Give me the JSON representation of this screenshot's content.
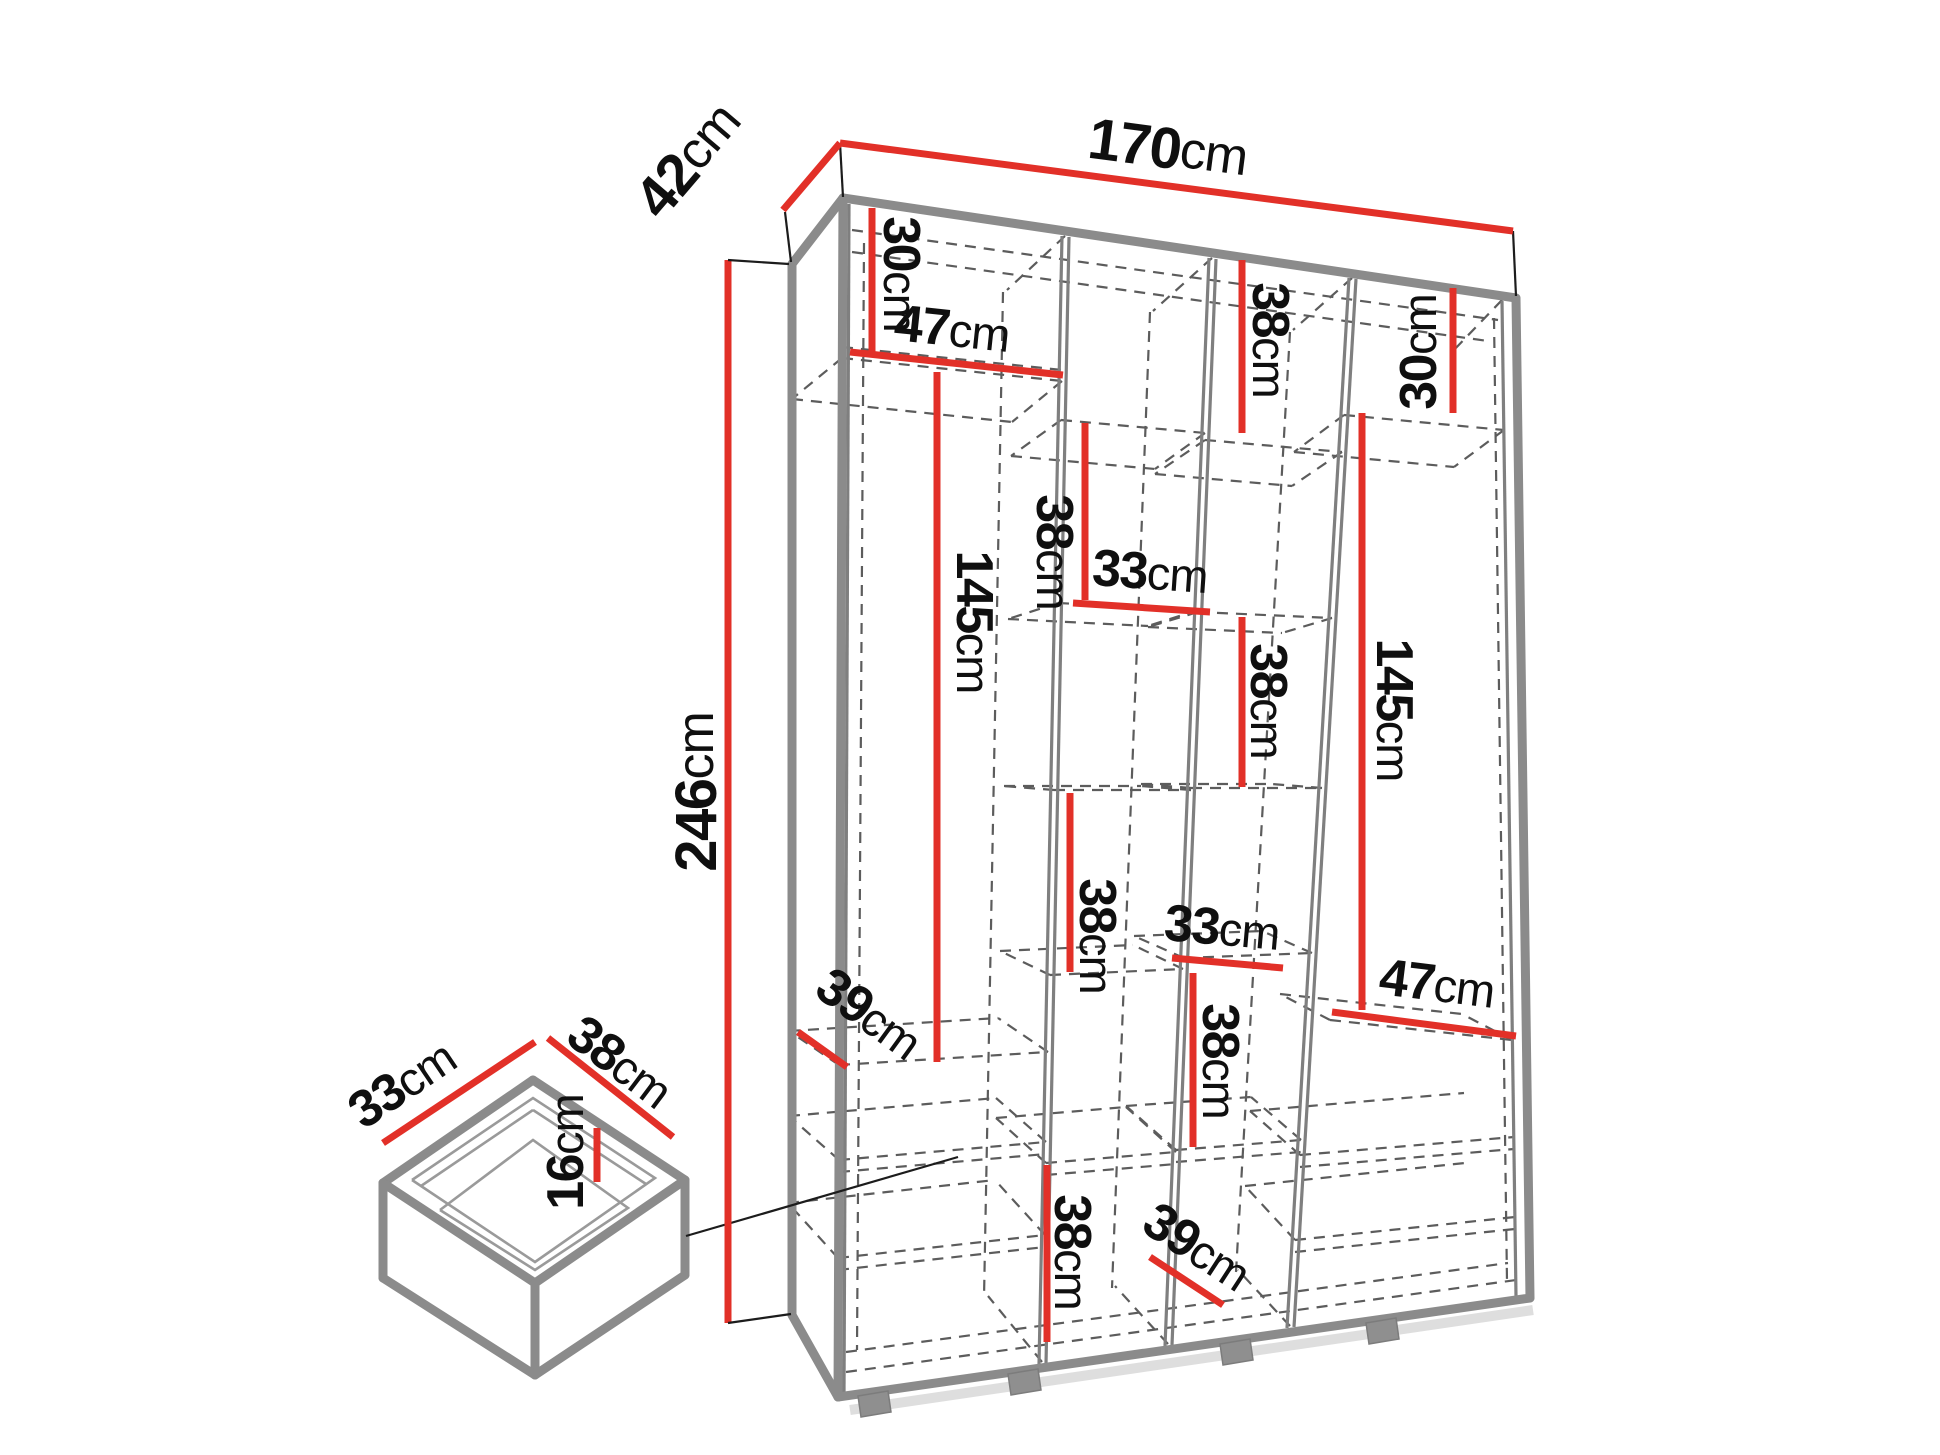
{
  "diagram": {
    "type": "furniture-dimension-diagram",
    "subject": "wardrobe with internal shelving and drawer",
    "unit": "cm",
    "overall": {
      "width_cm": "170",
      "depth_cm": "42",
      "height_cm": "246"
    },
    "dims": {
      "k42": {
        "value": "42",
        "unit": "cm"
      },
      "k170": {
        "value": "170",
        "unit": "cm"
      },
      "k246": {
        "value": "246",
        "unit": "cm"
      },
      "c1_30": {
        "value": "30",
        "unit": "cm"
      },
      "c1_47": {
        "value": "47",
        "unit": "cm"
      },
      "c1_145": {
        "value": "145",
        "unit": "cm"
      },
      "c1_39": {
        "value": "39",
        "unit": "cm"
      },
      "c2_38a": {
        "value": "38",
        "unit": "cm"
      },
      "c2_33": {
        "value": "33",
        "unit": "cm"
      },
      "c2_38b": {
        "value": "38",
        "unit": "cm"
      },
      "c2_38c": {
        "value": "38",
        "unit": "cm"
      },
      "c3_38a": {
        "value": "38",
        "unit": "cm"
      },
      "c3_38b": {
        "value": "38",
        "unit": "cm"
      },
      "c3_33": {
        "value": "33",
        "unit": "cm"
      },
      "c3_38c": {
        "value": "38",
        "unit": "cm"
      },
      "c3_39": {
        "value": "39",
        "unit": "cm"
      },
      "c4_30": {
        "value": "30",
        "unit": "cm"
      },
      "c4_145": {
        "value": "145",
        "unit": "cm"
      },
      "c4_47": {
        "value": "47",
        "unit": "cm"
      }
    },
    "drawer": {
      "width_cm": "38",
      "depth_cm": "33",
      "height_cm": "16",
      "dims": {
        "dw_33": {
          "value": "33",
          "unit": "cm"
        },
        "dw_38": {
          "value": "38",
          "unit": "cm"
        },
        "dw_16": {
          "value": "16",
          "unit": "cm"
        }
      }
    }
  }
}
